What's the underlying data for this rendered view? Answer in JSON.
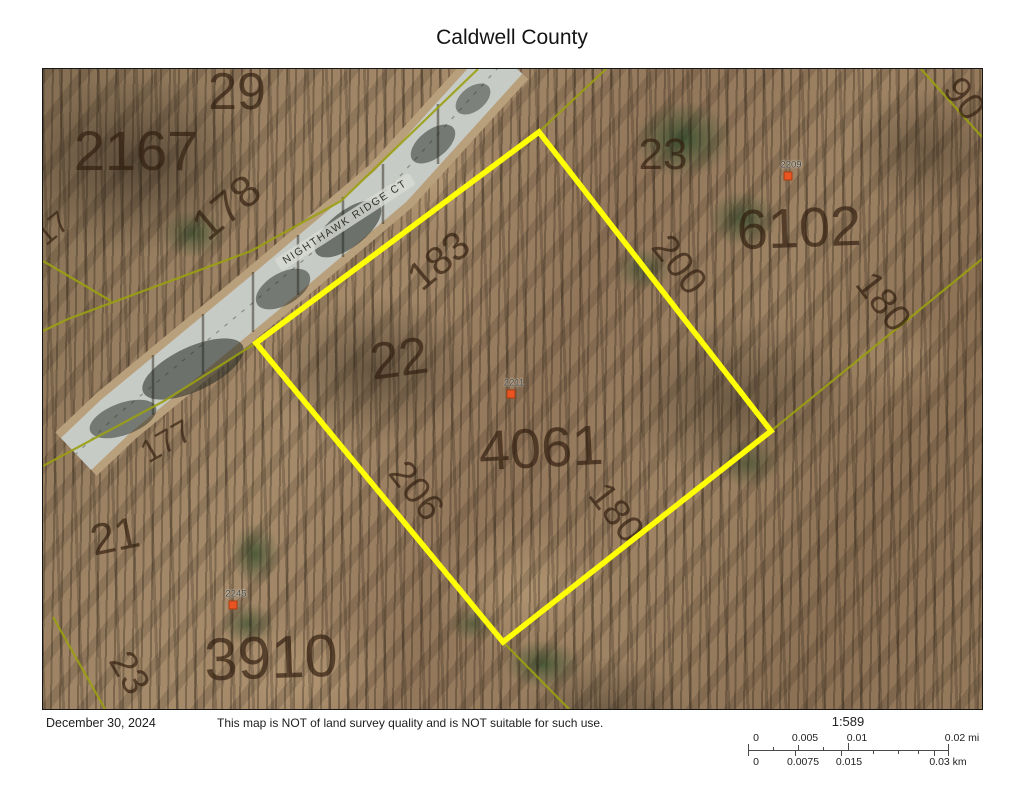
{
  "title": "Caldwell County",
  "map": {
    "road_label": {
      "text": "NIGHTHAWK RIDGE CT",
      "x": 302,
      "y": 153,
      "rot": -33
    },
    "road": {
      "color": "#c7cbc5",
      "shoulder_color": "#b9a07c",
      "path": "M463,-10 L348,117 L218,227 L73,347 L33,385",
      "shadows": [
        {
          "cx": 390,
          "cy": 75,
          "rx": 26,
          "ry": 14,
          "rot": -38,
          "o": 0.5
        },
        {
          "cx": 305,
          "cy": 160,
          "rx": 40,
          "ry": 18,
          "rot": -38,
          "o": 0.55
        },
        {
          "cx": 240,
          "cy": 220,
          "rx": 30,
          "ry": 16,
          "rot": -30,
          "o": 0.5
        },
        {
          "cx": 150,
          "cy": 300,
          "rx": 55,
          "ry": 22,
          "rot": -25,
          "o": 0.55
        },
        {
          "cx": 80,
          "cy": 350,
          "rx": 35,
          "ry": 16,
          "rot": -20,
          "o": 0.5
        },
        {
          "cx": 430,
          "cy": 30,
          "rx": 20,
          "ry": 12,
          "rot": -38,
          "o": 0.45
        }
      ],
      "trunks": [
        {
          "x": 395,
          "y1": 35,
          "y2": 95
        },
        {
          "x": 340,
          "y1": 95,
          "y2": 155
        },
        {
          "x": 300,
          "y1": 128,
          "y2": 188
        },
        {
          "x": 255,
          "y1": 166,
          "y2": 226
        },
        {
          "x": 210,
          "y1": 203,
          "y2": 263
        },
        {
          "x": 160,
          "y1": 245,
          "y2": 305
        },
        {
          "x": 110,
          "y1": 286,
          "y2": 346
        }
      ]
    },
    "boundary_color": "#9aa012",
    "boundaries": [
      {
        "name": "road-far-side-line",
        "points": "435,0 298,132 208,182 25,250 0,262"
      },
      {
        "name": "road-near-side-line",
        "points": "563,0 496,63 213,274 121,332 0,397"
      },
      {
        "name": "crossing-spur-line",
        "points": "0,192 68,232"
      },
      {
        "name": "right-extension-line",
        "points": "728,362 939,190"
      },
      {
        "name": "top-right-corner-line",
        "points": "878,0 939,68"
      },
      {
        "name": "bottom-left-line",
        "points": "10,548 62,640"
      },
      {
        "name": "bottom-extension-line",
        "points": "460,573 526,640"
      }
    ],
    "highlight": {
      "color": "#ffff05",
      "width": 5.5,
      "points": "496,63 728,362 460,573 213,274"
    },
    "parcel_labels": [
      {
        "text": "29",
        "x": 194,
        "y": 23,
        "size": 52,
        "rot": 0
      },
      {
        "text": "2167",
        "x": 93,
        "y": 82,
        "size": 56,
        "rot": 0
      },
      {
        "text": "178",
        "x": 184,
        "y": 139,
        "size": 44,
        "rot": -40
      },
      {
        "text": "17",
        "x": 10,
        "y": 160,
        "size": 30,
        "rot": -40
      },
      {
        "text": "183",
        "x": 396,
        "y": 192,
        "size": 40,
        "rot": -40
      },
      {
        "text": "22",
        "x": 356,
        "y": 290,
        "size": 52,
        "rot": -8
      },
      {
        "text": "177",
        "x": 123,
        "y": 372,
        "size": 32,
        "rot": -30
      },
      {
        "text": "21",
        "x": 72,
        "y": 468,
        "size": 44,
        "rot": -12
      },
      {
        "text": "206",
        "x": 373,
        "y": 422,
        "size": 38,
        "rot": 52
      },
      {
        "text": "4061",
        "x": 498,
        "y": 379,
        "size": 56,
        "rot": -3
      },
      {
        "text": "180",
        "x": 573,
        "y": 444,
        "size": 38,
        "rot": 52
      },
      {
        "text": "23",
        "x": 620,
        "y": 86,
        "size": 44,
        "rot": 0
      },
      {
        "text": "6102",
        "x": 756,
        "y": 159,
        "size": 56,
        "rot": -2
      },
      {
        "text": "200",
        "x": 636,
        "y": 196,
        "size": 38,
        "rot": 52
      },
      {
        "text": "180",
        "x": 840,
        "y": 233,
        "size": 38,
        "rot": 52
      },
      {
        "text": "90",
        "x": 921,
        "y": 30,
        "size": 38,
        "rot": 52
      },
      {
        "text": "3910",
        "x": 228,
        "y": 589,
        "size": 60,
        "rot": -2
      },
      {
        "text": "23",
        "x": 86,
        "y": 604,
        "size": 38,
        "rot": 60
      }
    ],
    "address_points": [
      {
        "text": "2209",
        "tx": 748,
        "ty": 96,
        "dx": 745,
        "dy": 107
      },
      {
        "text": "2211",
        "tx": 471,
        "ty": 314,
        "dx": 468,
        "dy": 325
      },
      {
        "text": "2245",
        "tx": 193,
        "ty": 525,
        "dx": 190,
        "dy": 536
      }
    ],
    "dot_color": "#ea5420"
  },
  "footer": {
    "date": "December 30, 2024",
    "disclaimer": "This map is NOT of land survey quality and is NOT suitable for such use.",
    "scale": {
      "ratio": "1:589",
      "mi_labels": [
        {
          "t": "0",
          "x": 8
        },
        {
          "t": "0.005",
          "x": 57
        },
        {
          "t": "0.01",
          "x": 109
        },
        {
          "t": "0.02 mi",
          "x": 214
        }
      ],
      "km_labels": [
        {
          "t": "0",
          "x": 8
        },
        {
          "t": "0.0075",
          "x": 55
        },
        {
          "t": "0.015",
          "x": 101
        },
        {
          "t": "0.03 km",
          "x": 200
        }
      ],
      "ticks": [
        {
          "x": 0,
          "dir": "both",
          "h": 6
        },
        {
          "x": 200,
          "dir": "both",
          "h": 6
        },
        {
          "x": 50,
          "dir": "up",
          "h": 5
        },
        {
          "x": 100,
          "dir": "up",
          "h": 7
        },
        {
          "x": 46.6,
          "dir": "down",
          "h": 5
        },
        {
          "x": 93.2,
          "dir": "down",
          "h": 5
        },
        {
          "x": 186.4,
          "dir": "down",
          "h": 5
        },
        {
          "x": 25,
          "dir": "up",
          "h": 3
        },
        {
          "x": 75,
          "dir": "up",
          "h": 3
        },
        {
          "x": 125,
          "dir": "down",
          "h": 3
        },
        {
          "x": 150,
          "dir": "down",
          "h": 3
        },
        {
          "x": 170,
          "dir": "down",
          "h": 3
        }
      ]
    }
  }
}
